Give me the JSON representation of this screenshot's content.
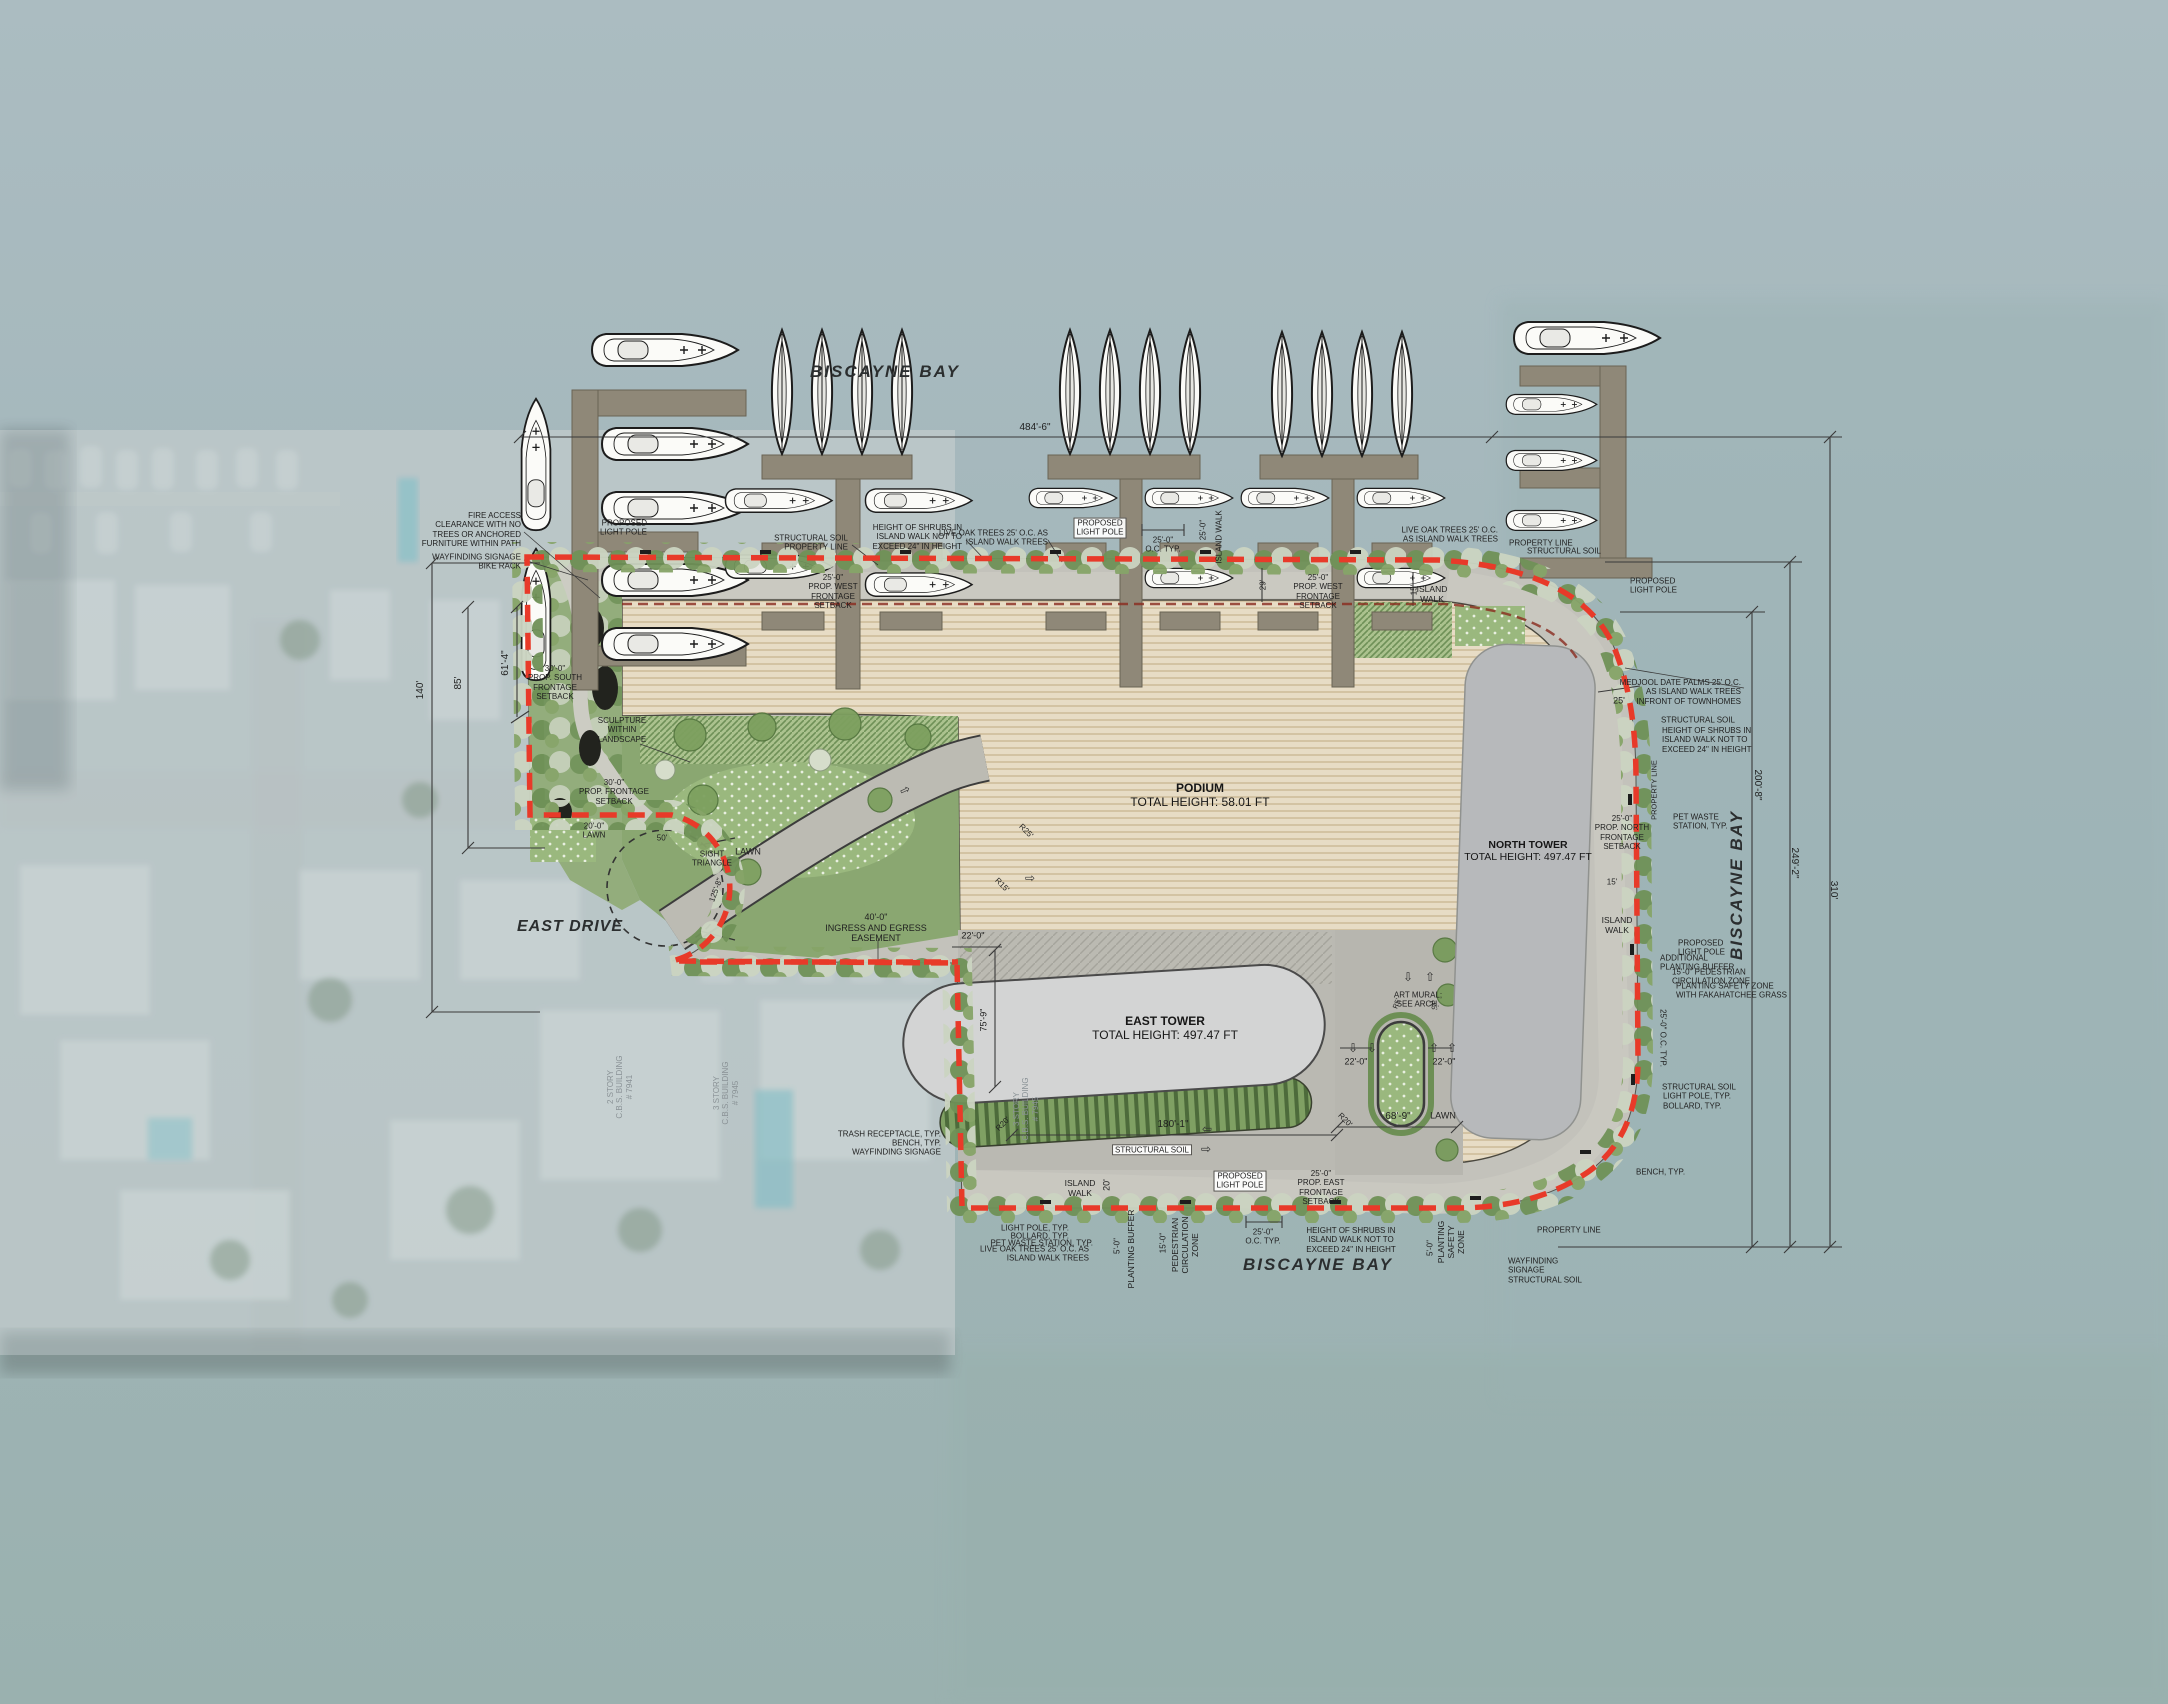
{
  "plan_type": "architectural site plan",
  "water_labels": {
    "top": "BISCAYNE BAY",
    "right": "BISCAYNE BAY",
    "bottom": "BISCAYNE BAY"
  },
  "street": {
    "name": "EAST DRIVE"
  },
  "buildings": {
    "podium": {
      "name": "PODIUM",
      "height": "TOTAL HEIGHT: 58.01 FT"
    },
    "east_tower": {
      "name": "EAST TOWER",
      "height": "TOTAL HEIGHT: 497.47 FT"
    },
    "north_tower": {
      "name": "NORTH TOWER",
      "height": "TOTAL HEIGHT: 497.47 FT"
    }
  },
  "colors": {
    "property_line": "#e83a29",
    "podium": "#e7dcc5",
    "tower": "#b7b9bb",
    "water": "#a2b6ba",
    "lawn": "#9ab87e",
    "pavement": "#c3c2bb",
    "dock": "#8f8878"
  },
  "annotations": [
    {
      "n": "dimension-label",
      "t": "484'-6\"",
      "x": 1035,
      "y": 428,
      "s": 10
    },
    {
      "n": "dimension-label",
      "t": "140'",
      "x": 421,
      "y": 690,
      "r": -90,
      "s": 10
    },
    {
      "n": "dimension-label",
      "t": "85'",
      "x": 459,
      "y": 683,
      "r": -90,
      "s": 10
    },
    {
      "n": "dimension-label",
      "t": "61'-4\"",
      "x": 506,
      "y": 663,
      "r": -90,
      "s": 10
    },
    {
      "n": "dimension-label",
      "t": "200'-8\"",
      "x": 1757,
      "y": 785,
      "r": 90,
      "s": 10
    },
    {
      "n": "dimension-label",
      "t": "249'-2\"",
      "x": 1794,
      "y": 863,
      "r": 90,
      "s": 10
    },
    {
      "n": "dimension-label",
      "t": "310'",
      "x": 1833,
      "y": 890,
      "r": 90,
      "s": 10
    },
    {
      "n": "dimension-label",
      "t": "180'-1\"",
      "x": 1173,
      "y": 1125,
      "s": 10
    },
    {
      "n": "dimension-label",
      "t": "68'-9\"",
      "x": 1398,
      "y": 1117,
      "s": 10
    },
    {
      "n": "dimension-label",
      "t": "75'-9\"",
      "x": 984,
      "y": 1020,
      "r": -90,
      "s": 9
    },
    {
      "n": "dimension-label",
      "t": "22'-0\"",
      "x": 973,
      "y": 936,
      "s": 9
    },
    {
      "n": "dimension-label",
      "t": "22'-0\"",
      "x": 1356,
      "y": 1062,
      "s": 9
    },
    {
      "n": "dimension-label",
      "t": "22'-0\"",
      "x": 1444,
      "y": 1062,
      "s": 9
    },
    {
      "n": "dimension-label",
      "t": "25'",
      "x": 1619,
      "y": 701,
      "s": 9
    },
    {
      "n": "dimension-label",
      "t": "29'",
      "x": 1263,
      "y": 585,
      "r": -90,
      "s": 8
    },
    {
      "n": "dimension-label",
      "t": "20'",
      "x": 1107,
      "y": 1185,
      "r": -90,
      "s": 9
    },
    {
      "n": "dimension-label",
      "t": "50'",
      "x": 662,
      "y": 838,
      "s": 8
    },
    {
      "n": "dimension-label",
      "t": "125'-8\"",
      "x": 716,
      "y": 890,
      "r": -70,
      "s": 8
    },
    {
      "n": "dimension-label",
      "t": "15'",
      "x": 1414,
      "y": 590,
      "r": -90,
      "s": 8
    },
    {
      "n": "dimension-label",
      "t": "15'",
      "x": 1612,
      "y": 882,
      "s": 8
    },
    {
      "n": "dimension-label",
      "t": "25'-0\"\nO.C. TYP.",
      "x": 1163,
      "y": 545,
      "s": 8
    },
    {
      "n": "dimension-label",
      "t": "25'-0\"\nO.C. TYP.",
      "x": 1263,
      "y": 1237,
      "s": 8
    },
    {
      "n": "dimension-label",
      "t": "25'-0\"  O.C. TYP.",
      "x": 1663,
      "y": 1038,
      "r": 90,
      "s": 8
    },
    {
      "t": "25'-0\"",
      "x": 1203,
      "y": 530,
      "r": -90,
      "s": 8
    },
    {
      "t": "ISLAND WALK",
      "x": 1219,
      "y": 537,
      "r": -90,
      "s": 8
    },
    {
      "t": "ISLAND\nWALK",
      "x": 1432,
      "y": 594,
      "s": 8.5
    },
    {
      "t": "ISLAND\nWALK",
      "x": 1617,
      "y": 925,
      "s": 8.5
    },
    {
      "t": "ISLAND\nWALK",
      "x": 1080,
      "y": 1188,
      "s": 8.5
    },
    {
      "t": "5'-0\"",
      "x": 1117,
      "y": 1246,
      "r": -90,
      "s": 8
    },
    {
      "t": "PLANTING BUFFER",
      "x": 1131,
      "y": 1249,
      "r": -90,
      "s": 8.5
    },
    {
      "t": "15'-0\"",
      "x": 1163,
      "y": 1243,
      "r": -90,
      "s": 8
    },
    {
      "t": "PEDESTRIAN\nCIRCULATION\nZONE",
      "x": 1185,
      "y": 1245,
      "r": -90,
      "s": 8.5
    },
    {
      "t": "5'-0\"",
      "x": 1430,
      "y": 1248,
      "r": -90,
      "s": 8
    },
    {
      "t": "PLANTING\nSAFETY\nZONE",
      "x": 1451,
      "y": 1242,
      "r": -90,
      "s": 8.5
    },
    {
      "t": "PROPERTY LINE",
      "x": 1655,
      "y": 790,
      "r": -90,
      "s": 7.5
    },
    {
      "t": "FIRE ACCESS\nCLEARANCE WITH NO\nTREES OR ANCHORED\nFURNITURE WITHIN PATH",
      "x": 521,
      "y": 530,
      "a": "r"
    },
    {
      "t": "WAYFINDING SIGNAGE\nBIKE RACK",
      "x": 521,
      "y": 562,
      "a": "r"
    },
    {
      "t": "PROPOSED\nLIGHT POLE",
      "x": 647,
      "y": 528,
      "a": "r"
    },
    {
      "t": "STRUCTURAL SOIL\nPROPERTY LINE",
      "x": 848,
      "y": 543,
      "a": "r"
    },
    {
      "t": "HEIGHT OF SHRUBS IN\nISLAND WALK NOT TO\nEXCEED 24\" IN HEIGHT",
      "x": 962,
      "y": 537,
      "a": "r"
    },
    {
      "t": "LIVE OAK TREES 25' O.C. AS\nISLAND WALK TREES",
      "x": 1048,
      "y": 538,
      "a": "r"
    },
    {
      "t": "PROPOSED\nLIGHT POLE",
      "x": 1100,
      "y": 528,
      "box": true
    },
    {
      "t": "25'-0\"\nPROP. WEST\nFRONTAGE\nSETBACK",
      "x": 833,
      "y": 592
    },
    {
      "t": "25'-0\"\nPROP. WEST\nFRONTAGE\nSETBACK",
      "x": 1318,
      "y": 592
    },
    {
      "t": "LIVE OAK TREES 25' O.C.\nAS ISLAND WALK TREES",
      "x": 1498,
      "y": 535,
      "a": "r"
    },
    {
      "t": "PROPERTY LINE",
      "x": 1509,
      "y": 543,
      "a": "l"
    },
    {
      "t": "STRUCTURAL SOIL",
      "x": 1527,
      "y": 551,
      "a": "l"
    },
    {
      "t": "PROPOSED\nLIGHT POLE",
      "x": 1630,
      "y": 586,
      "a": "l"
    },
    {
      "t": "MEDJOOL DATE PALMS 25' O.C.\nAS ISLAND WALK TREES\nINFRONT OF TOWNHOMES",
      "x": 1741,
      "y": 692,
      "a": "r"
    },
    {
      "t": "STRUCTURAL SOIL",
      "x": 1661,
      "y": 720,
      "a": "l"
    },
    {
      "t": "HEIGHT OF SHRUBS IN\nISLAND WALK NOT TO\nEXCEED 24\" IN HEIGHT",
      "x": 1662,
      "y": 740,
      "a": "l"
    },
    {
      "t": "25'-0\"\nPROP. NORTH\nFRONTAGE\nSETBACK",
      "x": 1622,
      "y": 833
    },
    {
      "t": "PET WASTE\nSTATION, TYP.",
      "x": 1673,
      "y": 822,
      "a": "l"
    },
    {
      "t": "PROPOSED\nLIGHT POLE",
      "x": 1678,
      "y": 948,
      "a": "l"
    },
    {
      "t": "ADDITIONAL\nPLANTING BUFFER",
      "x": 1660,
      "y": 963,
      "a": "l"
    },
    {
      "t": "15'-0\" PEDESTRIAN\nCIRCULATION ZONE",
      "x": 1672,
      "y": 977,
      "a": "l"
    },
    {
      "t": "PLANTING SAFETY ZONE\nWITH FAKAHATCHEE GRASS",
      "x": 1676,
      "y": 991,
      "a": "l"
    },
    {
      "t": "STRUCTURAL SOIL",
      "x": 1662,
      "y": 1087,
      "a": "l"
    },
    {
      "t": "LIGHT POLE, TYP.",
      "x": 1663,
      "y": 1096,
      "a": "l"
    },
    {
      "t": "BOLLARD, TYP.",
      "x": 1663,
      "y": 1106,
      "a": "l"
    },
    {
      "t": "BENCH, TYP.",
      "x": 1636,
      "y": 1172,
      "a": "l"
    },
    {
      "t": "PROPERTY LINE",
      "x": 1537,
      "y": 1230,
      "a": "l"
    },
    {
      "t": "WAYFINDING\nSIGNAGE",
      "x": 1508,
      "y": 1266,
      "a": "l"
    },
    {
      "t": "STRUCTURAL SOIL",
      "x": 1508,
      "y": 1280,
      "a": "l"
    },
    {
      "t": "LIGHT POLE, TYP.",
      "x": 1069,
      "y": 1228,
      "a": "r"
    },
    {
      "t": "BOLLARD, TYP.",
      "x": 1069,
      "y": 1236,
      "a": "r"
    },
    {
      "t": "PET WASTE STATION, TYP.",
      "x": 1093,
      "y": 1243,
      "a": "r"
    },
    {
      "t": "LIVE OAK TREES 25' O.C. AS\nISLAND WALK TREES",
      "x": 1089,
      "y": 1254,
      "a": "r"
    },
    {
      "t": "TRASH RECEPTACLE, TYP.",
      "x": 941,
      "y": 1134,
      "a": "r"
    },
    {
      "t": "BENCH, TYP.",
      "x": 941,
      "y": 1143,
      "a": "r"
    },
    {
      "t": "WAYFINDING SIGNAGE",
      "x": 941,
      "y": 1152,
      "a": "r"
    },
    {
      "t": "PROPOSED\nLIGHT POLE",
      "x": 1240,
      "y": 1181,
      "box": true
    },
    {
      "t": "25'-0\"\nPROP. EAST\nFRONTAGE\nSETBACK",
      "x": 1321,
      "y": 1188
    },
    {
      "t": "HEIGHT OF SHRUBS IN\nISLAND WALK NOT TO\nEXCEED 24\" IN HEIGHT",
      "x": 1351,
      "y": 1240
    },
    {
      "t": "STRUCTURAL SOIL",
      "x": 1152,
      "y": 1150,
      "box": true
    },
    {
      "t": "ART MURAL;\nSEE ARCH.",
      "x": 1418,
      "y": 1000
    },
    {
      "t": "SCULPTURE\nWITHIN\nLANDSCAPE",
      "x": 622,
      "y": 730
    },
    {
      "t": "30'-0\"\nPROP. SOUTH\nFRONTAGE\nSETBACK",
      "x": 555,
      "y": 683
    },
    {
      "t": "30'-0\"\nPROP. FRONTAGE\nSETBACK",
      "x": 614,
      "y": 792
    },
    {
      "t": "20'-0\"\nLAWN",
      "x": 594,
      "y": 831
    },
    {
      "t": "SIGHT\nTRIANGLE",
      "x": 712,
      "y": 859
    },
    {
      "t": "40'-0\"\nINGRESS AND EGRESS\nEASEMENT",
      "x": 876,
      "y": 928,
      "s": 9
    },
    {
      "t": "LAWN",
      "x": 748,
      "y": 852,
      "s": 9
    },
    {
      "t": "LAWN",
      "x": 1443,
      "y": 1116,
      "s": 9
    },
    {
      "t": "R20'",
      "x": 1003,
      "y": 1124,
      "r": -45,
      "s": 8
    },
    {
      "t": "R20'",
      "x": 1345,
      "y": 1120,
      "r": 45,
      "s": 8
    },
    {
      "t": "R25'",
      "x": 1026,
      "y": 831,
      "r": 45,
      "s": 8
    },
    {
      "t": "R15'",
      "x": 1002,
      "y": 885,
      "r": 45,
      "s": 8
    },
    {
      "t": "R5'",
      "x": 1398,
      "y": 1004,
      "r": -70,
      "s": 7
    },
    {
      "t": "R5'",
      "x": 1432,
      "y": 1006,
      "r": 70,
      "s": 7
    },
    {
      "n": "aerial-building-label",
      "t": "2 STORY\nC.B.S. BUILDING\n# 7941",
      "x": 620,
      "y": 1087,
      "r": -90,
      "s": 8,
      "c": "#8a9296"
    },
    {
      "n": "aerial-building-label",
      "t": "3 STORY\nC.B.S. BUILDING\n# 7945",
      "x": 726,
      "y": 1093,
      "r": -90,
      "s": 8,
      "c": "#8a9296"
    },
    {
      "n": "aerial-building-label",
      "t": "3 STORY\nC.B.S. BUILDING\n# 7945",
      "x": 1026,
      "y": 1109,
      "r": -90,
      "s": 8,
      "c": "#8a9296"
    },
    {
      "n": "pavement-arrow",
      "t": "⇩",
      "x": 1408,
      "y": 977,
      "s": 12,
      "c": "#2f2f2f"
    },
    {
      "n": "pavement-arrow",
      "t": "⇧",
      "x": 1430,
      "y": 977,
      "s": 12,
      "c": "#2f2f2f"
    },
    {
      "n": "pavement-arrow",
      "t": "⇩",
      "x": 1353,
      "y": 1048,
      "s": 12,
      "c": "#2f2f2f"
    },
    {
      "n": "pavement-arrow",
      "t": "⇩",
      "x": 1372,
      "y": 1048,
      "s": 12,
      "c": "#2f2f2f"
    },
    {
      "n": "pavement-arrow",
      "t": "⇧",
      "x": 1434,
      "y": 1048,
      "s": 12,
      "c": "#2f2f2f"
    },
    {
      "n": "pavement-arrow",
      "t": "⇧",
      "x": 1452,
      "y": 1048,
      "s": 12,
      "c": "#2f2f2f"
    },
    {
      "n": "pavement-arrow",
      "t": "⇦",
      "x": 1207,
      "y": 1129,
      "s": 12,
      "c": "#2f2f2f"
    },
    {
      "n": "pavement-arrow",
      "t": "⇨",
      "x": 1206,
      "y": 1149,
      "s": 12,
      "c": "#2f2f2f"
    },
    {
      "n": "pavement-arrow",
      "t": "⇨",
      "x": 905,
      "y": 790,
      "r": -25,
      "s": 12,
      "c": "#2f2f2f"
    },
    {
      "n": "pavement-arrow",
      "t": "⇨",
      "x": 1030,
      "y": 878,
      "s": 12,
      "c": "#2f2f2f"
    }
  ]
}
